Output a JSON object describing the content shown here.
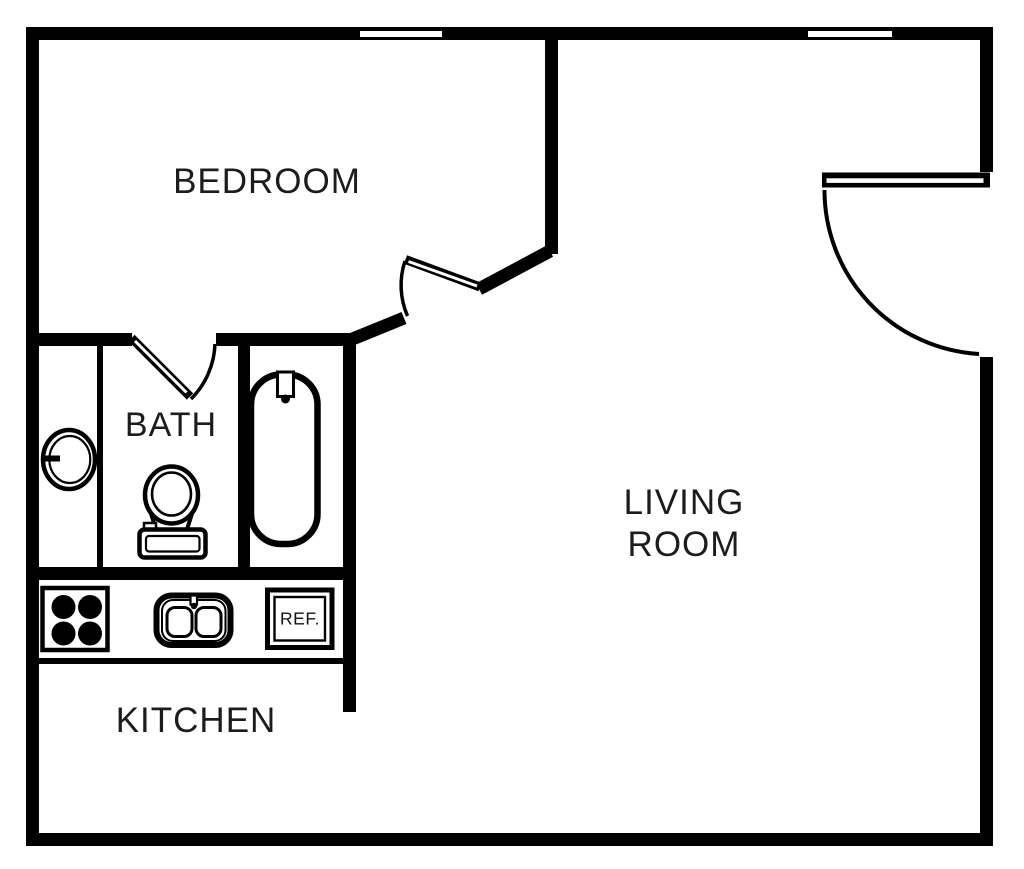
{
  "floor_plan": {
    "type": "apartment-floor-plan",
    "colors": {
      "wall": "#000000",
      "background": "#ffffff",
      "text": "#1c1c1c"
    },
    "rooms": {
      "bedroom": {
        "label": "BEDROOM"
      },
      "bath": {
        "label": "BATH"
      },
      "living_room": {
        "label": "LIVING\nROOM"
      },
      "kitchen": {
        "label": "KITCHEN"
      }
    },
    "fixtures": {
      "refrigerator": {
        "label": "REF."
      },
      "items": [
        "stove-cooktop",
        "kitchen-double-sink",
        "refrigerator",
        "bathtub",
        "toilet",
        "vanity-basin"
      ],
      "doors": [
        "entry-door",
        "bedroom-door",
        "bath-door"
      ],
      "windows": [
        "bedroom-window",
        "living-room-window"
      ]
    }
  }
}
